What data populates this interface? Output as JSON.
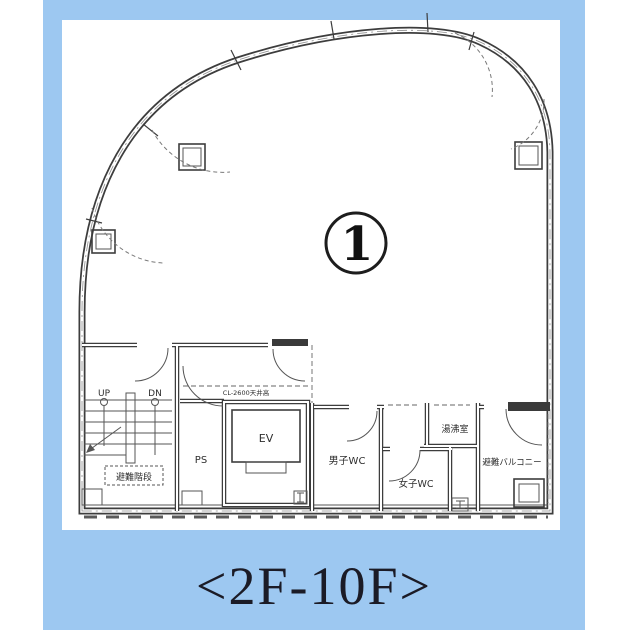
{
  "colors": {
    "panel_bg": "#9DC8F1",
    "caption_color": "#1B1B26"
  },
  "caption": {
    "text": "<2F-10F>"
  },
  "plan": {
    "unit_badge": "1",
    "labels": {
      "up": "UP",
      "dn": "DN",
      "evac_stairs": "避難階段",
      "ps": "PS",
      "ev": "EV",
      "mens_wc": "男子WC",
      "womens_wc": "女子WC",
      "kitchenette": "湯沸室",
      "evac_balcony": "避難バルコニー",
      "ceiling_note": "CL-2600天井高"
    }
  }
}
